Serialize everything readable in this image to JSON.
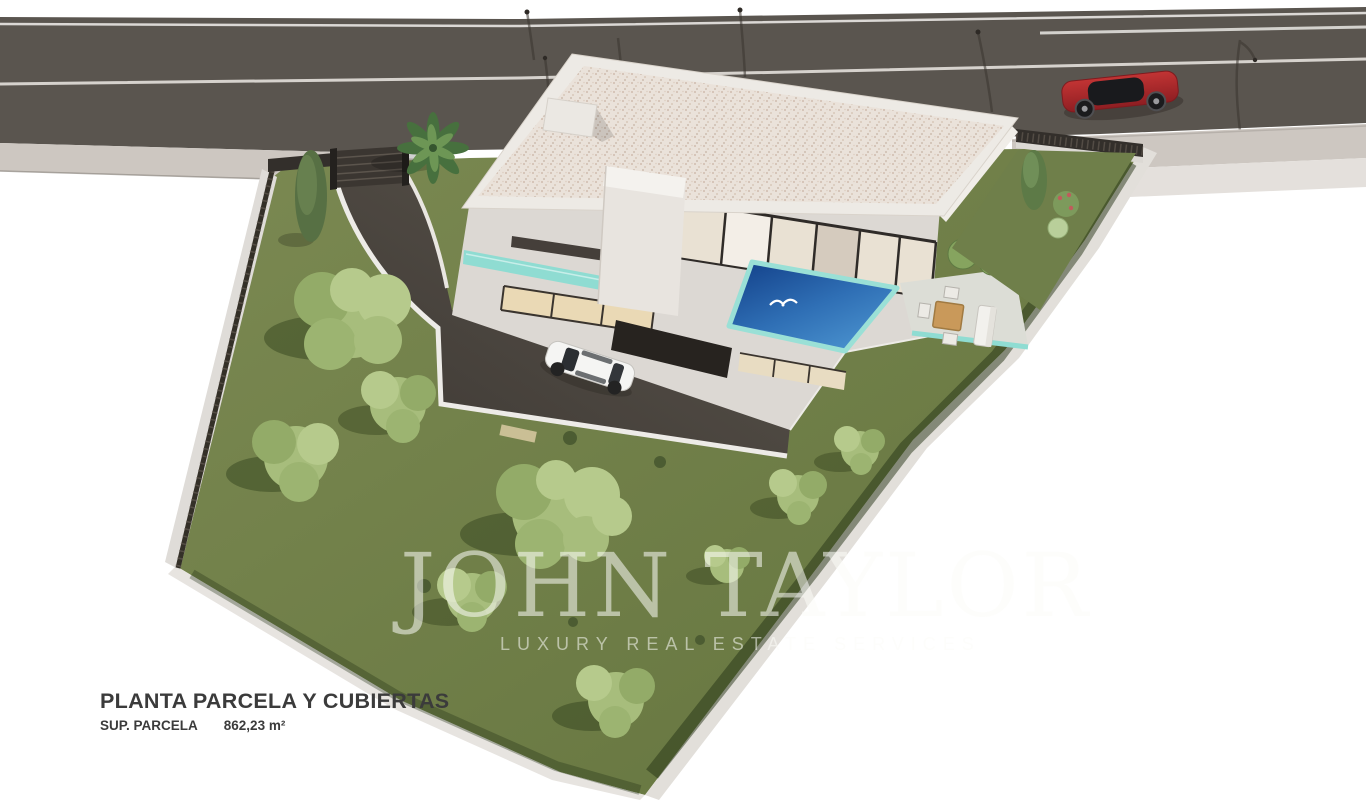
{
  "labels": {
    "plan_title": "PLANTA PARCELA Y CUBIERTAS",
    "plot_area_label": "SUP. PARCELA",
    "plot_area_value": "862,23 m²"
  },
  "watermark": {
    "brand": "JOHN TAYLOR",
    "tagline": "LUXURY REAL ESTATE SERVICES"
  },
  "colors": {
    "road": "#5a554f",
    "sidewalk": "#cdc7c1",
    "lawn": "#71814d",
    "tree_canopy": "#a7bd7c",
    "pool_deep": "#123f88",
    "pool_light": "#4b93cf",
    "glass_teal": "#8fdcd2",
    "roof_gravel": "#eae2da",
    "house_wall": "#dcd8d3",
    "driveway": "#4a453f",
    "fence_dark": "#332f2b",
    "wall_light": "#e2dfda",
    "car_red": "#b12a2c",
    "car_white": "#f5f5f3",
    "label_text": "#3b3b3b",
    "watermark_tint": "rgba(252,252,248,0.55)"
  },
  "scene_objects": [
    "road",
    "sidewalk",
    "perimeter-fence",
    "entrance-gate",
    "driveway",
    "villa",
    "flat-gravel-roof",
    "swimming-pool",
    "seagull",
    "terrace",
    "outdoor-dining-set",
    "outdoor-sofa",
    "garden-lawn",
    "garden-trees",
    "palm-tree",
    "cypress-tree",
    "white-car",
    "red-car"
  ]
}
